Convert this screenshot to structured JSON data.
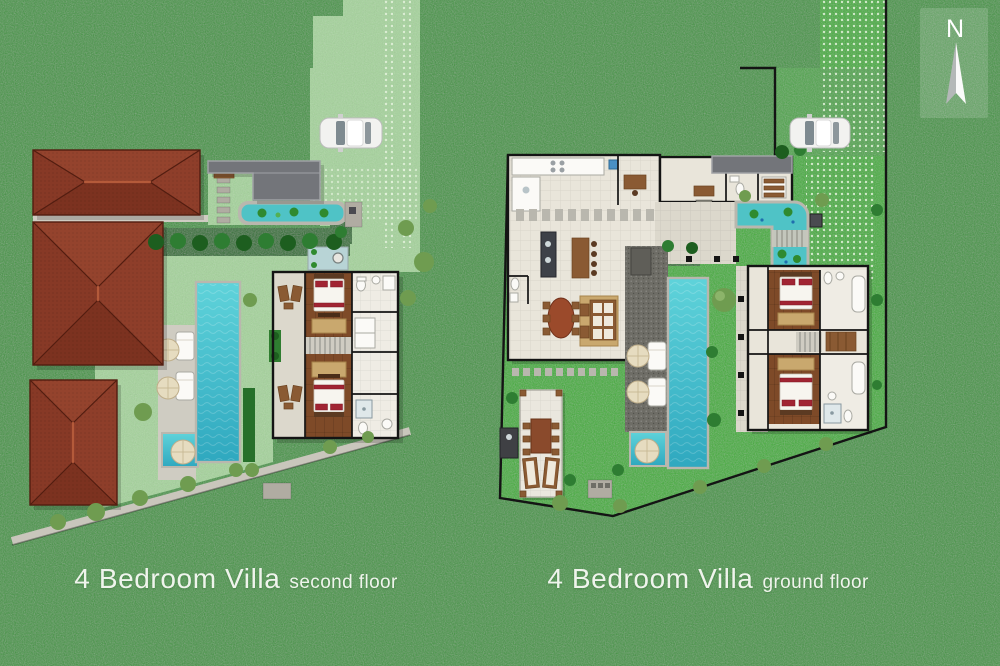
{
  "compass": {
    "letter": "N"
  },
  "plans": [
    {
      "id": "second-floor",
      "title": "4 Bedroom Villa",
      "subtitle": "second floor"
    },
    {
      "id": "ground-floor",
      "title": "4 Bedroom Villa",
      "subtitle": "ground floor"
    }
  ],
  "colors": {
    "grass": "#419540",
    "lawn": "#3cad33",
    "pale": "#a5d49b",
    "front_lawn": "#4aa545",
    "path": "#cfccc2",
    "floor": "#e9e5da",
    "tile": "#efece4",
    "terrace": "#dcd8cc",
    "wall": "#141414",
    "hedge": "#26702a",
    "gravel": "#6e6d66",
    "pond": "#4fc3c6",
    "coping": "#b9b7ae",
    "bed_red": "#a12433",
    "umbrella": "#e6dcc0",
    "label": "#f4f7f1"
  }
}
